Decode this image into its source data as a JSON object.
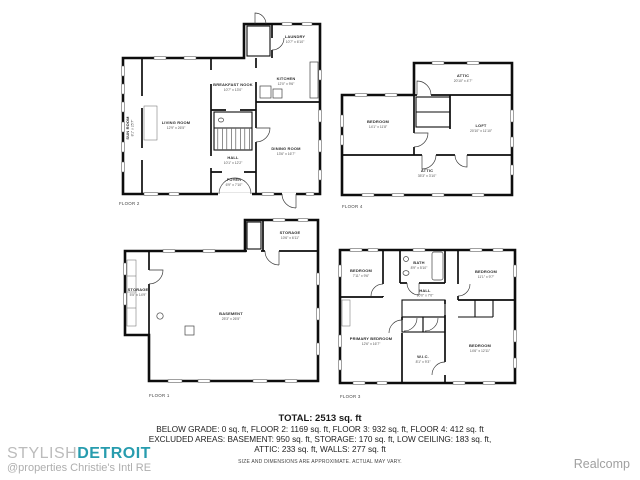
{
  "floors": {
    "floor2": {
      "label": "FLOOR 2",
      "rooms": {
        "sun_room": {
          "name": "SUN ROOM",
          "dims": "8'1\" x 25'7\""
        },
        "living": {
          "name": "LIVING ROOM",
          "dims": "12'9\" x 26'5\""
        },
        "breakfast": {
          "name": "BREAKFAST NOOK",
          "dims": "10'7\" x 13'0\""
        },
        "kitchen": {
          "name": "KITCHEN",
          "dims": "12'0\" x 9'6\""
        },
        "laundry": {
          "name": "LAUNDRY",
          "dims": "10'7\" x 6'10\""
        },
        "dining": {
          "name": "DINING ROOM",
          "dims": "13'6\" x 16'7\""
        },
        "hall": {
          "name": "HALL",
          "dims": "10'1\" x 12'2\""
        },
        "foyer": {
          "name": "FOYER",
          "dims": "6'9\" x 7'10\""
        }
      }
    },
    "floor4": {
      "label": "FLOOR 4",
      "rooms": {
        "attic_top": {
          "name": "ATTIC",
          "dims": "20'10\" x 4'7\""
        },
        "bedroom": {
          "name": "BEDROOM",
          "dims": "14'1\" x 11'8\""
        },
        "loft": {
          "name": "LOFT",
          "dims": "20'10\" x 11'10\""
        },
        "attic_bottom": {
          "name": "ATTIC",
          "dims": "35'3\" x 3'10\""
        }
      }
    },
    "floor1": {
      "label": "FLOOR 1",
      "rooms": {
        "storage_left": {
          "name": "STORAGE",
          "dims": "5'5\" x 14'9\""
        },
        "basement": {
          "name": "BASEMENT",
          "dims": "25'3\" x 26'5\""
        },
        "storage_top": {
          "name": "STORAGE",
          "dims": "10'6\" x 6'11\""
        }
      }
    },
    "floor3": {
      "label": "FLOOR 3",
      "rooms": {
        "bedroom_tl": {
          "name": "BEDROOM",
          "dims": "7'11\" x 9'6\""
        },
        "bath": {
          "name": "BATH",
          "dims": "8'9\" x 5'10\""
        },
        "bedroom_tr": {
          "name": "BEDROOM",
          "dims": "11'1\" x 9'7\""
        },
        "hall": {
          "name": "HALL",
          "dims": "10'0\" x 7'0\""
        },
        "primary": {
          "name": "PRIMARY BEDROOM",
          "dims": "12'6\" x 16'7\""
        },
        "wic": {
          "name": "W.I.C.",
          "dims": "8'1\" x 9'3\""
        },
        "bedroom_br": {
          "name": "BEDROOM",
          "dims": "14'6\" x 12'11\""
        }
      }
    }
  },
  "summary": {
    "total": "TOTAL: 2513 sq. ft",
    "line1": "BELOW GRADE: 0 sq. ft, FLOOR 2: 1169 sq. ft, FLOOR 3: 932 sq. ft, FLOOR 4: 412 sq. ft",
    "line2": "EXCLUDED AREAS: BASEMENT: 950 sq. ft, STORAGE: 170 sq. ft, LOW CEILING: 183 sq. ft,",
    "line3": "ATTIC: 233 sq. ft, WALLS: 277 sq. ft",
    "disclaimer": "SIZE AND DIMENSIONS ARE APPROXIMATE. ACTUAL MAY VARY."
  },
  "branding": {
    "studio_light": "STYLISH",
    "studio_bold": "DETROIT",
    "studio_sub": "@properties Christie's Intl RE",
    "mls": "Realcomp",
    "accent_color": "#279cae",
    "muted_color": "#bcbcbc"
  }
}
